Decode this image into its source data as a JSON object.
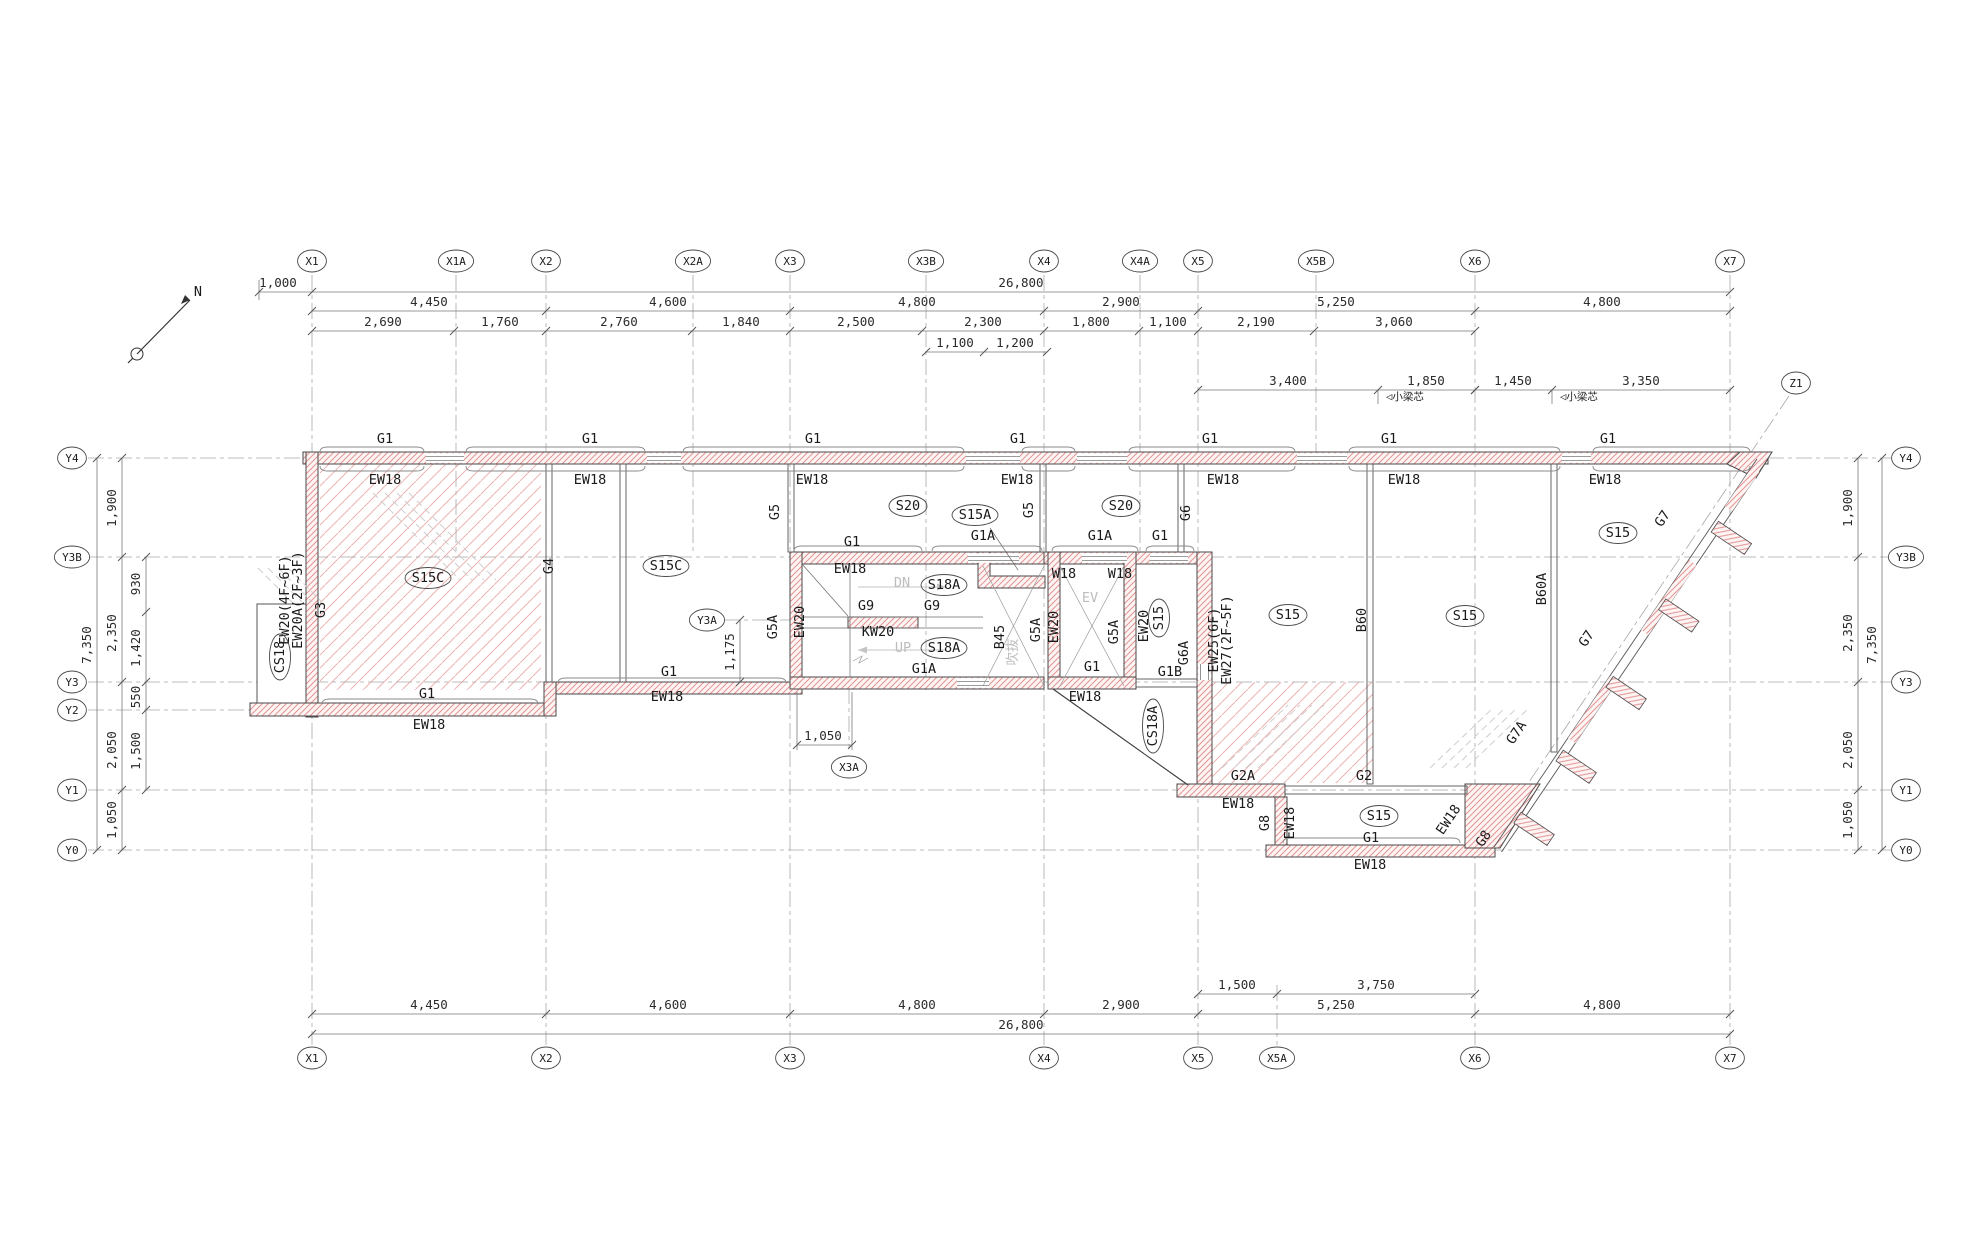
{
  "drawing": {
    "kind": "structural framing floor plan",
    "accent_hatch_color": "#e59595",
    "room_hatch_color": "#eeb3b3",
    "line_color": "#4a4a4a"
  },
  "grid": {
    "bubbles": [
      {
        "id": "X1",
        "x": 312,
        "y": 261,
        "l": [
          312,
          275,
          312,
          1045
        ]
      },
      {
        "id": "X1A",
        "x": 456,
        "y": 261,
        "l": [
          456,
          275,
          456,
          552
        ]
      },
      {
        "id": "X2",
        "x": 546,
        "y": 261,
        "l": [
          546,
          275,
          546,
          1045
        ]
      },
      {
        "id": "X2A",
        "x": 693,
        "y": 261,
        "l": [
          693,
          275,
          693,
          552
        ]
      },
      {
        "id": "X3",
        "x": 790,
        "y": 261,
        "l": [
          790,
          275,
          790,
          1045
        ]
      },
      {
        "id": "X3B",
        "x": 926,
        "y": 261,
        "l": [
          926,
          275,
          926,
          690
        ]
      },
      {
        "id": "X4",
        "x": 1044,
        "y": 261,
        "l": [
          1044,
          275,
          1044,
          1045
        ]
      },
      {
        "id": "X4A",
        "x": 1140,
        "y": 261,
        "l": [
          1140,
          275,
          1140,
          552
        ]
      },
      {
        "id": "X5",
        "x": 1198,
        "y": 261,
        "l": [
          1198,
          275,
          1198,
          1045
        ]
      },
      {
        "id": "X5B",
        "x": 1316,
        "y": 261,
        "l": [
          1316,
          275,
          1316,
          462
        ]
      },
      {
        "id": "X6",
        "x": 1475,
        "y": 261,
        "l": [
          1475,
          275,
          1475,
          1045
        ]
      },
      {
        "id": "X7",
        "x": 1730,
        "y": 261,
        "l": [
          1730,
          275,
          1730,
          1045
        ]
      },
      {
        "id": "X1",
        "x": 312,
        "y": 1058
      },
      {
        "id": "X2",
        "x": 546,
        "y": 1058
      },
      {
        "id": "X3",
        "x": 790,
        "y": 1058
      },
      {
        "id": "X4",
        "x": 1044,
        "y": 1058
      },
      {
        "id": "X5",
        "x": 1198,
        "y": 1058
      },
      {
        "id": "X5A",
        "x": 1277,
        "y": 1058,
        "l": [
          1277,
          985,
          1277,
          1045
        ]
      },
      {
        "id": "X6",
        "x": 1475,
        "y": 1058
      },
      {
        "id": "X7",
        "x": 1730,
        "y": 1058
      },
      {
        "id": "Y4",
        "x": 72,
        "y": 458,
        "l": [
          88,
          458,
          1892,
          458
        ]
      },
      {
        "id": "Y3B",
        "x": 72,
        "y": 557,
        "l": [
          88,
          557,
          1892,
          557
        ]
      },
      {
        "id": "Y3",
        "x": 72,
        "y": 682,
        "l": [
          88,
          682,
          1892,
          682
        ]
      },
      {
        "id": "Y2",
        "x": 72,
        "y": 710,
        "l": [
          88,
          710,
          420,
          710
        ]
      },
      {
        "id": "Y1",
        "x": 72,
        "y": 790,
        "l": [
          88,
          790,
          1892,
          790
        ]
      },
      {
        "id": "Y0",
        "x": 72,
        "y": 850,
        "l": [
          88,
          850,
          1892,
          850
        ]
      },
      {
        "id": "Y4",
        "x": 1906,
        "y": 458
      },
      {
        "id": "Y3B",
        "x": 1906,
        "y": 557
      },
      {
        "id": "Y3",
        "x": 1906,
        "y": 682
      },
      {
        "id": "Y1",
        "x": 1906,
        "y": 790
      },
      {
        "id": "Y0",
        "x": 1906,
        "y": 850
      },
      {
        "id": "X3A",
        "x": 849,
        "y": 767,
        "l": [
          849,
          688,
          849,
          748
        ]
      },
      {
        "id": "Y3A",
        "x": 707,
        "y": 620,
        "l": [
          724,
          620,
          798,
          620
        ]
      },
      {
        "id": "Z1",
        "x": 1796,
        "y": 383,
        "l": [
          1789,
          396,
          1502,
          822
        ]
      }
    ]
  },
  "dims": {
    "lines": [
      {
        "o": "h",
        "y": 292,
        "x1": 259,
        "x2": 1730,
        "ticks": [
          259,
          312,
          1730
        ]
      },
      {
        "o": "h",
        "y": 311,
        "x1": 312,
        "x2": 1730,
        "ticks": [
          312,
          546,
          790,
          1044,
          1198,
          1475,
          1730
        ]
      },
      {
        "o": "h",
        "y": 331,
        "x1": 312,
        "x2": 1475,
        "ticks": [
          312,
          454,
          546,
          692,
          790,
          922,
          1044,
          1139,
          1198,
          1314,
          1475
        ]
      },
      {
        "o": "h",
        "y": 352,
        "x1": 926,
        "x2": 1047,
        "ticks": [
          926,
          984,
          1047
        ]
      },
      {
        "o": "h",
        "y": 390,
        "x1": 1198,
        "x2": 1475,
        "ticks": [
          1198,
          1378,
          1475
        ]
      },
      {
        "o": "h",
        "y": 390,
        "x1": 1475,
        "x2": 1730,
        "ticks": [
          1475,
          1552,
          1730
        ]
      },
      {
        "o": "h",
        "y": 994,
        "x1": 1198,
        "x2": 1475,
        "ticks": [
          1198,
          1277,
          1475
        ]
      },
      {
        "o": "h",
        "y": 1014,
        "x1": 312,
        "x2": 1730,
        "ticks": [
          312,
          546,
          790,
          1044,
          1198,
          1475,
          1730
        ]
      },
      {
        "o": "h",
        "y": 1034,
        "x1": 312,
        "x2": 1730,
        "ticks": [
          312,
          1730
        ]
      },
      {
        "o": "v",
        "x": 97,
        "y1": 458,
        "y2": 850,
        "ticks": [
          458,
          850
        ]
      },
      {
        "o": "v",
        "x": 122,
        "y1": 458,
        "y2": 850,
        "ticks": [
          458,
          557,
          682,
          790,
          850
        ]
      },
      {
        "o": "v",
        "x": 146,
        "y1": 557,
        "y2": 790,
        "ticks": [
          557,
          612,
          682,
          710,
          790
        ]
      },
      {
        "o": "v",
        "x": 1858,
        "y1": 458,
        "y2": 850,
        "ticks": [
          458,
          557,
          682,
          790,
          850
        ]
      },
      {
        "o": "v",
        "x": 1882,
        "y1": 458,
        "y2": 850,
        "ticks": [
          458,
          850
        ]
      },
      {
        "o": "v",
        "x": 740,
        "y1": 620,
        "y2": 682,
        "ticks": [
          620,
          682
        ]
      },
      {
        "o": "h",
        "y": 745,
        "x1": 797,
        "x2": 852,
        "ticks": [
          797,
          852
        ]
      }
    ],
    "texts": [
      {
        "t": "1,000",
        "x": 278,
        "y": 287
      },
      {
        "t": "26,800",
        "x": 1021,
        "y": 287
      },
      {
        "t": "4,450",
        "x": 429,
        "y": 306
      },
      {
        "t": "4,600",
        "x": 668,
        "y": 306
      },
      {
        "t": "4,800",
        "x": 917,
        "y": 306
      },
      {
        "t": "2,900",
        "x": 1121,
        "y": 306
      },
      {
        "t": "5,250",
        "x": 1336,
        "y": 306
      },
      {
        "t": "4,800",
        "x": 1602,
        "y": 306
      },
      {
        "t": "2,690",
        "x": 383,
        "y": 326
      },
      {
        "t": "1,760",
        "x": 500,
        "y": 326
      },
      {
        "t": "2,760",
        "x": 619,
        "y": 326
      },
      {
        "t": "1,840",
        "x": 741,
        "y": 326
      },
      {
        "t": "2,500",
        "x": 856,
        "y": 326
      },
      {
        "t": "2,300",
        "x": 983,
        "y": 326
      },
      {
        "t": "1,800",
        "x": 1091,
        "y": 326
      },
      {
        "t": "1,100",
        "x": 1168,
        "y": 326
      },
      {
        "t": "2,190",
        "x": 1256,
        "y": 326
      },
      {
        "t": "3,060",
        "x": 1394,
        "y": 326
      },
      {
        "t": "1,100",
        "x": 955,
        "y": 347
      },
      {
        "t": "1,200",
        "x": 1015,
        "y": 347
      },
      {
        "t": "3,400",
        "x": 1288,
        "y": 385
      },
      {
        "t": "1,850",
        "x": 1426,
        "y": 385
      },
      {
        "t": "1,450",
        "x": 1513,
        "y": 385
      },
      {
        "t": "3,350",
        "x": 1641,
        "y": 385
      },
      {
        "t": "1,500",
        "x": 1237,
        "y": 989
      },
      {
        "t": "3,750",
        "x": 1376,
        "y": 989
      },
      {
        "t": "4,450",
        "x": 429,
        "y": 1009
      },
      {
        "t": "4,600",
        "x": 668,
        "y": 1009
      },
      {
        "t": "4,800",
        "x": 917,
        "y": 1009
      },
      {
        "t": "2,900",
        "x": 1121,
        "y": 1009
      },
      {
        "t": "5,250",
        "x": 1336,
        "y": 1009
      },
      {
        "t": "4,800",
        "x": 1602,
        "y": 1009
      },
      {
        "t": "26,800",
        "x": 1021,
        "y": 1029
      },
      {
        "t": "7,350",
        "x": 91,
        "y": 645,
        "r": -90
      },
      {
        "t": "1,900",
        "x": 116,
        "y": 508,
        "r": -90
      },
      {
        "t": "2,350",
        "x": 116,
        "y": 633,
        "r": -90
      },
      {
        "t": "2,050",
        "x": 116,
        "y": 750,
        "r": -90
      },
      {
        "t": "1,050",
        "x": 116,
        "y": 820,
        "r": -90
      },
      {
        "t": "930",
        "x": 140,
        "y": 584,
        "r": -90
      },
      {
        "t": "1,420",
        "x": 140,
        "y": 648,
        "r": -90
      },
      {
        "t": "550",
        "x": 140,
        "y": 697,
        "r": -90
      },
      {
        "t": "1,500",
        "x": 140,
        "y": 751,
        "r": -90
      },
      {
        "t": "1,900",
        "x": 1852,
        "y": 508,
        "r": -90
      },
      {
        "t": "2,350",
        "x": 1852,
        "y": 633,
        "r": -90
      },
      {
        "t": "2,050",
        "x": 1852,
        "y": 750,
        "r": -90
      },
      {
        "t": "1,050",
        "x": 1852,
        "y": 820,
        "r": -90
      },
      {
        "t": "7,350",
        "x": 1876,
        "y": 645,
        "r": -90
      },
      {
        "t": "1,175",
        "x": 734,
        "y": 652,
        "r": -90
      },
      {
        "t": "1,050",
        "x": 823,
        "y": 740
      }
    ]
  },
  "labels": [
    {
      "t": "G1",
      "x": 385,
      "y": 443
    },
    {
      "t": "G1",
      "x": 590,
      "y": 443
    },
    {
      "t": "G1",
      "x": 813,
      "y": 443
    },
    {
      "t": "G1",
      "x": 1018,
      "y": 443
    },
    {
      "t": "G1",
      "x": 1210,
      "y": 443
    },
    {
      "t": "G1",
      "x": 1389,
      "y": 443
    },
    {
      "t": "G1",
      "x": 1608,
      "y": 443
    },
    {
      "t": "EW18",
      "x": 385,
      "y": 484
    },
    {
      "t": "EW18",
      "x": 590,
      "y": 484
    },
    {
      "t": "EW18",
      "x": 812,
      "y": 484
    },
    {
      "t": "EW18",
      "x": 1017,
      "y": 484
    },
    {
      "t": "EW18",
      "x": 1223,
      "y": 484
    },
    {
      "t": "EW18",
      "x": 1404,
      "y": 484
    },
    {
      "t": "EW18",
      "x": 1605,
      "y": 484
    },
    {
      "t": "EW20(4F~6F)",
      "x": 289,
      "y": 600,
      "r": -90
    },
    {
      "t": "EW20A(2F~3F)",
      "x": 302,
      "y": 600,
      "r": -90
    },
    {
      "t": "G3",
      "x": 325,
      "y": 610,
      "r": -90
    },
    {
      "t": "CS18",
      "x": 284,
      "y": 657,
      "r": -90,
      "o": 1
    },
    {
      "t": "S15C",
      "x": 428,
      "y": 582,
      "o": 1
    },
    {
      "t": "G1",
      "x": 427,
      "y": 698
    },
    {
      "t": "EW18",
      "x": 429,
      "y": 729
    },
    {
      "t": "G4",
      "x": 553,
      "y": 566,
      "r": -90
    },
    {
      "t": "S15C",
      "x": 666,
      "y": 570,
      "o": 1
    },
    {
      "t": "G1",
      "x": 669,
      "y": 676
    },
    {
      "t": "EW18",
      "x": 667,
      "y": 701
    },
    {
      "t": "G5",
      "x": 779,
      "y": 512,
      "r": -90
    },
    {
      "t": "G5A",
      "x": 777,
      "y": 627,
      "r": -90
    },
    {
      "t": "EW20",
      "x": 804,
      "y": 622,
      "r": -90
    },
    {
      "t": "S20",
      "x": 908,
      "y": 510,
      "o": 1
    },
    {
      "t": "S15A",
      "x": 975,
      "y": 519,
      "o": 1
    },
    {
      "t": "G1A",
      "x": 983,
      "y": 540
    },
    {
      "t": "G5",
      "x": 1033,
      "y": 510,
      "r": -90
    },
    {
      "t": "G1",
      "x": 852,
      "y": 546
    },
    {
      "t": "EW18",
      "x": 850,
      "y": 573
    },
    {
      "t": "DN",
      "x": 902,
      "y": 587,
      "g": 1
    },
    {
      "t": "S18A",
      "x": 944,
      "y": 589,
      "o": 1
    },
    {
      "t": "G9",
      "x": 866,
      "y": 610
    },
    {
      "t": "G9",
      "x": 932,
      "y": 610
    },
    {
      "t": "KW20",
      "x": 878,
      "y": 636
    },
    {
      "t": "UP",
      "x": 903,
      "y": 652,
      "g": 1
    },
    {
      "t": "S18A",
      "x": 944,
      "y": 652,
      "o": 1
    },
    {
      "t": "G1A",
      "x": 924,
      "y": 673
    },
    {
      "t": "B45",
      "x": 1004,
      "y": 637,
      "r": -90
    },
    {
      "t": "吹抜",
      "x": 1017,
      "y": 652,
      "r": -90,
      "g": 1
    },
    {
      "t": "G5A",
      "x": 1040,
      "y": 630,
      "r": -90
    },
    {
      "t": "W18",
      "x": 1064,
      "y": 578
    },
    {
      "t": "W18",
      "x": 1120,
      "y": 578
    },
    {
      "t": "EW20",
      "x": 1058,
      "y": 627,
      "r": -90
    },
    {
      "t": "EV",
      "x": 1090,
      "y": 602,
      "g": 1
    },
    {
      "t": "G5A",
      "x": 1118,
      "y": 632,
      "r": -90
    },
    {
      "t": "G1",
      "x": 1092,
      "y": 671
    },
    {
      "t": "EW18",
      "x": 1085,
      "y": 701
    },
    {
      "t": "S20",
      "x": 1121,
      "y": 510,
      "o": 1
    },
    {
      "t": "G1A",
      "x": 1100,
      "y": 540
    },
    {
      "t": "G6",
      "x": 1190,
      "y": 513,
      "r": -90
    },
    {
      "t": "G1",
      "x": 1160,
      "y": 540
    },
    {
      "t": "EW20",
      "x": 1148,
      "y": 626,
      "r": -90
    },
    {
      "t": "S15",
      "x": 1163,
      "y": 618,
      "r": -90,
      "o": 1
    },
    {
      "t": "G6A",
      "x": 1188,
      "y": 653,
      "r": -90
    },
    {
      "t": "G1B",
      "x": 1170,
      "y": 676
    },
    {
      "t": "EW25(6F)",
      "x": 1218,
      "y": 640,
      "r": -90
    },
    {
      "t": "EW27(2F~5F)",
      "x": 1231,
      "y": 640,
      "r": -90
    },
    {
      "t": "CS18A",
      "x": 1157,
      "y": 726,
      "r": -90,
      "o": 1
    },
    {
      "t": "G2A",
      "x": 1243,
      "y": 780
    },
    {
      "t": "G2",
      "x": 1364,
      "y": 780
    },
    {
      "t": "EW18",
      "x": 1238,
      "y": 808
    },
    {
      "t": "G8",
      "x": 1269,
      "y": 823,
      "r": -90
    },
    {
      "t": "EW18",
      "x": 1294,
      "y": 823,
      "r": -90
    },
    {
      "t": "S15",
      "x": 1379,
      "y": 820,
      "o": 1
    },
    {
      "t": "G1",
      "x": 1371,
      "y": 842
    },
    {
      "t": "EW18",
      "x": 1370,
      "y": 869
    },
    {
      "t": "S15",
      "x": 1288,
      "y": 619,
      "o": 1
    },
    {
      "t": "B60",
      "x": 1366,
      "y": 620,
      "r": -90
    },
    {
      "t": "S15",
      "x": 1465,
      "y": 620,
      "o": 1
    },
    {
      "t": "B60A",
      "x": 1546,
      "y": 589,
      "r": -90
    },
    {
      "t": "S15",
      "x": 1618,
      "y": 537,
      "o": 1
    },
    {
      "t": "G7",
      "x": 1666,
      "y": 521,
      "r": -56
    },
    {
      "t": "G7",
      "x": 1590,
      "y": 641,
      "r": -56
    },
    {
      "t": "G7A",
      "x": 1520,
      "y": 735,
      "r": -56
    },
    {
      "t": "EW18",
      "x": 1452,
      "y": 822,
      "r": -56
    },
    {
      "t": "G8",
      "x": 1487,
      "y": 841,
      "r": -56
    },
    {
      "t": "◁小梁芯",
      "x": 1405,
      "y": 400,
      "s": 1
    },
    {
      "t": "◁小梁芯",
      "x": 1579,
      "y": 400,
      "s": 1
    },
    {
      "t": "N",
      "x": 198,
      "y": 296
    }
  ]
}
